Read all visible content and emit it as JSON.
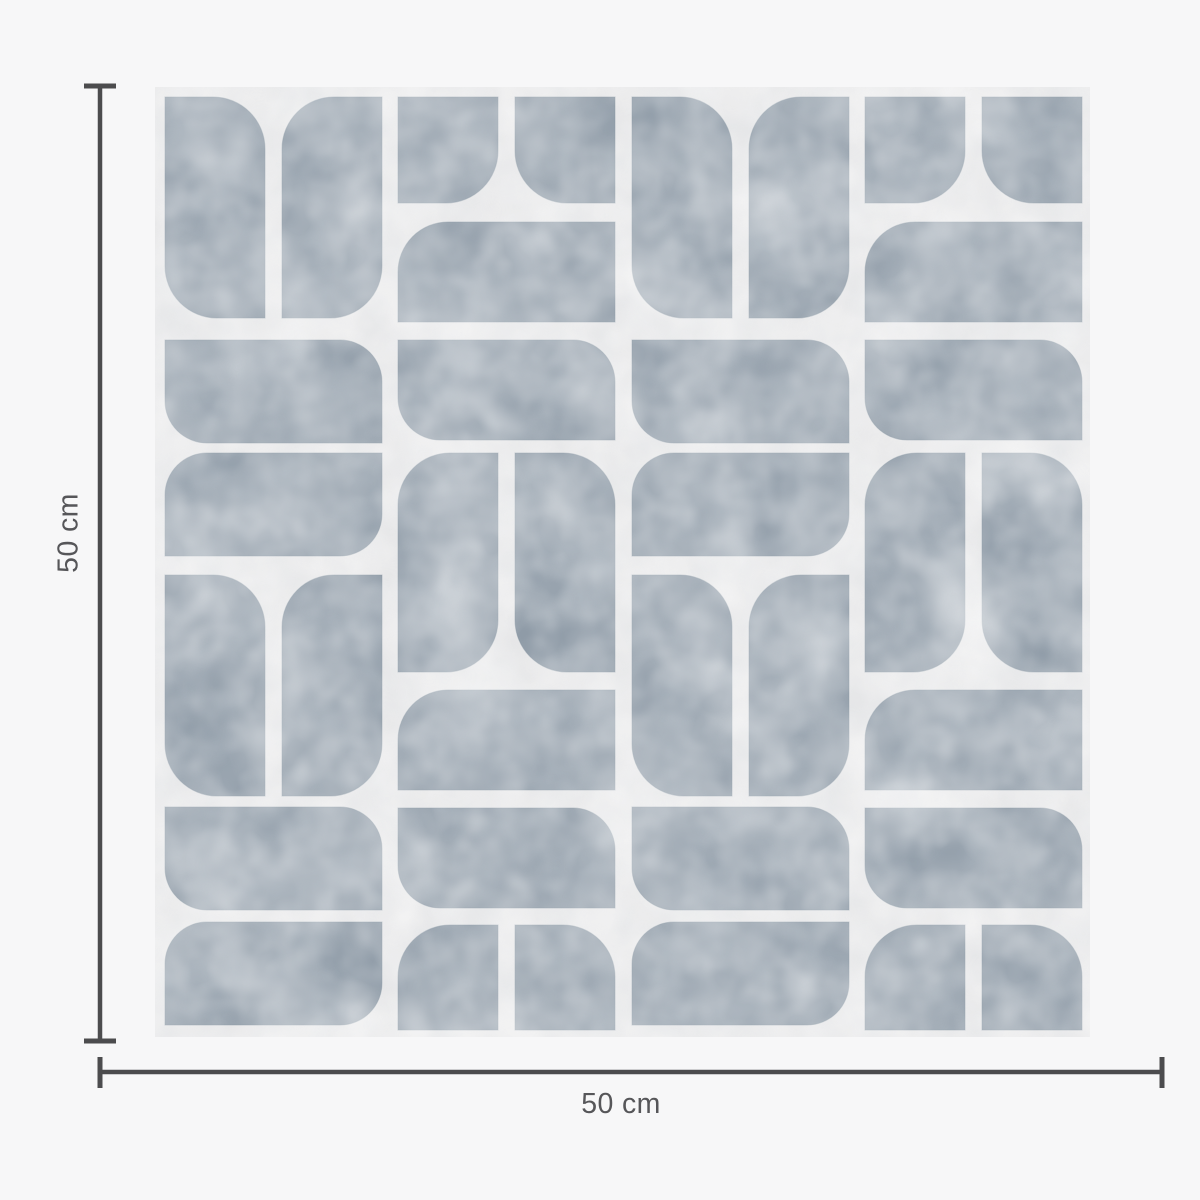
{
  "page": {
    "background": "#f7f7f8"
  },
  "product": {
    "description": "Mid-century geometric petal tile pattern swatch",
    "swatch": {
      "x": 155,
      "y": 87,
      "width": 935,
      "height": 950,
      "background": "#e8e8e9",
      "motif_color": "#8f9ba7",
      "motif_outline": "#7f8d9b"
    },
    "pattern": {
      "shapes": [
        [
          165,
          97,
          100,
          221,
          52,
          "tr bl"
        ],
        [
          282,
          97,
          100,
          221,
          52,
          "tl br"
        ],
        [
          165,
          340,
          217,
          103,
          42,
          "bl tr"
        ],
        [
          165,
          453,
          217,
          103,
          42,
          "tl br"
        ],
        [
          165,
          575,
          100,
          221,
          52,
          "tr bl"
        ],
        [
          282,
          575,
          100,
          221,
          52,
          "tl br"
        ],
        [
          165,
          807,
          217,
          103,
          42,
          "bl tr"
        ],
        [
          165,
          922,
          217,
          103,
          42,
          "tl br"
        ],
        [
          398,
          97,
          100,
          106,
          52,
          "br"
        ],
        [
          515,
          97,
          100,
          106,
          52,
          "bl"
        ],
        [
          398,
          222,
          217,
          100,
          50,
          "tl"
        ],
        [
          398,
          340,
          217,
          100,
          42,
          "bl tr"
        ],
        [
          398,
          453,
          100,
          219,
          52,
          "tl br"
        ],
        [
          515,
          453,
          100,
          219,
          52,
          "tr bl"
        ],
        [
          398,
          690,
          217,
          100,
          50,
          "tl"
        ],
        [
          398,
          808,
          217,
          100,
          42,
          "bl tr"
        ],
        [
          398,
          925,
          100,
          105,
          52,
          "tl"
        ],
        [
          515,
          925,
          100,
          105,
          52,
          "tr"
        ],
        [
          632,
          97,
          100,
          221,
          52,
          "tr bl"
        ],
        [
          749,
          97,
          100,
          221,
          52,
          "tl br"
        ],
        [
          632,
          340,
          217,
          103,
          42,
          "bl tr"
        ],
        [
          632,
          453,
          217,
          103,
          42,
          "tl br"
        ],
        [
          632,
          575,
          100,
          221,
          52,
          "tr bl"
        ],
        [
          749,
          575,
          100,
          221,
          52,
          "tl br"
        ],
        [
          632,
          807,
          217,
          103,
          42,
          "bl tr"
        ],
        [
          632,
          922,
          217,
          103,
          42,
          "tl br"
        ],
        [
          865,
          97,
          100,
          106,
          52,
          "br"
        ],
        [
          982,
          97,
          100,
          106,
          52,
          "bl"
        ],
        [
          865,
          222,
          217,
          100,
          50,
          "tl"
        ],
        [
          865,
          340,
          217,
          100,
          42,
          "bl tr"
        ],
        [
          865,
          453,
          100,
          219,
          52,
          "tl br"
        ],
        [
          982,
          453,
          100,
          219,
          52,
          "tr bl"
        ],
        [
          865,
          690,
          217,
          100,
          50,
          "tl"
        ],
        [
          865,
          808,
          217,
          100,
          42,
          "bl tr"
        ],
        [
          865,
          925,
          100,
          105,
          52,
          "tl"
        ],
        [
          982,
          925,
          100,
          105,
          52,
          "tr"
        ]
      ]
    }
  },
  "annotations": {
    "line_color": "#4c4c4e",
    "text_color": "#565659",
    "vertical": {
      "label": "50 cm"
    },
    "horizontal": {
      "label": "50 cm"
    }
  }
}
